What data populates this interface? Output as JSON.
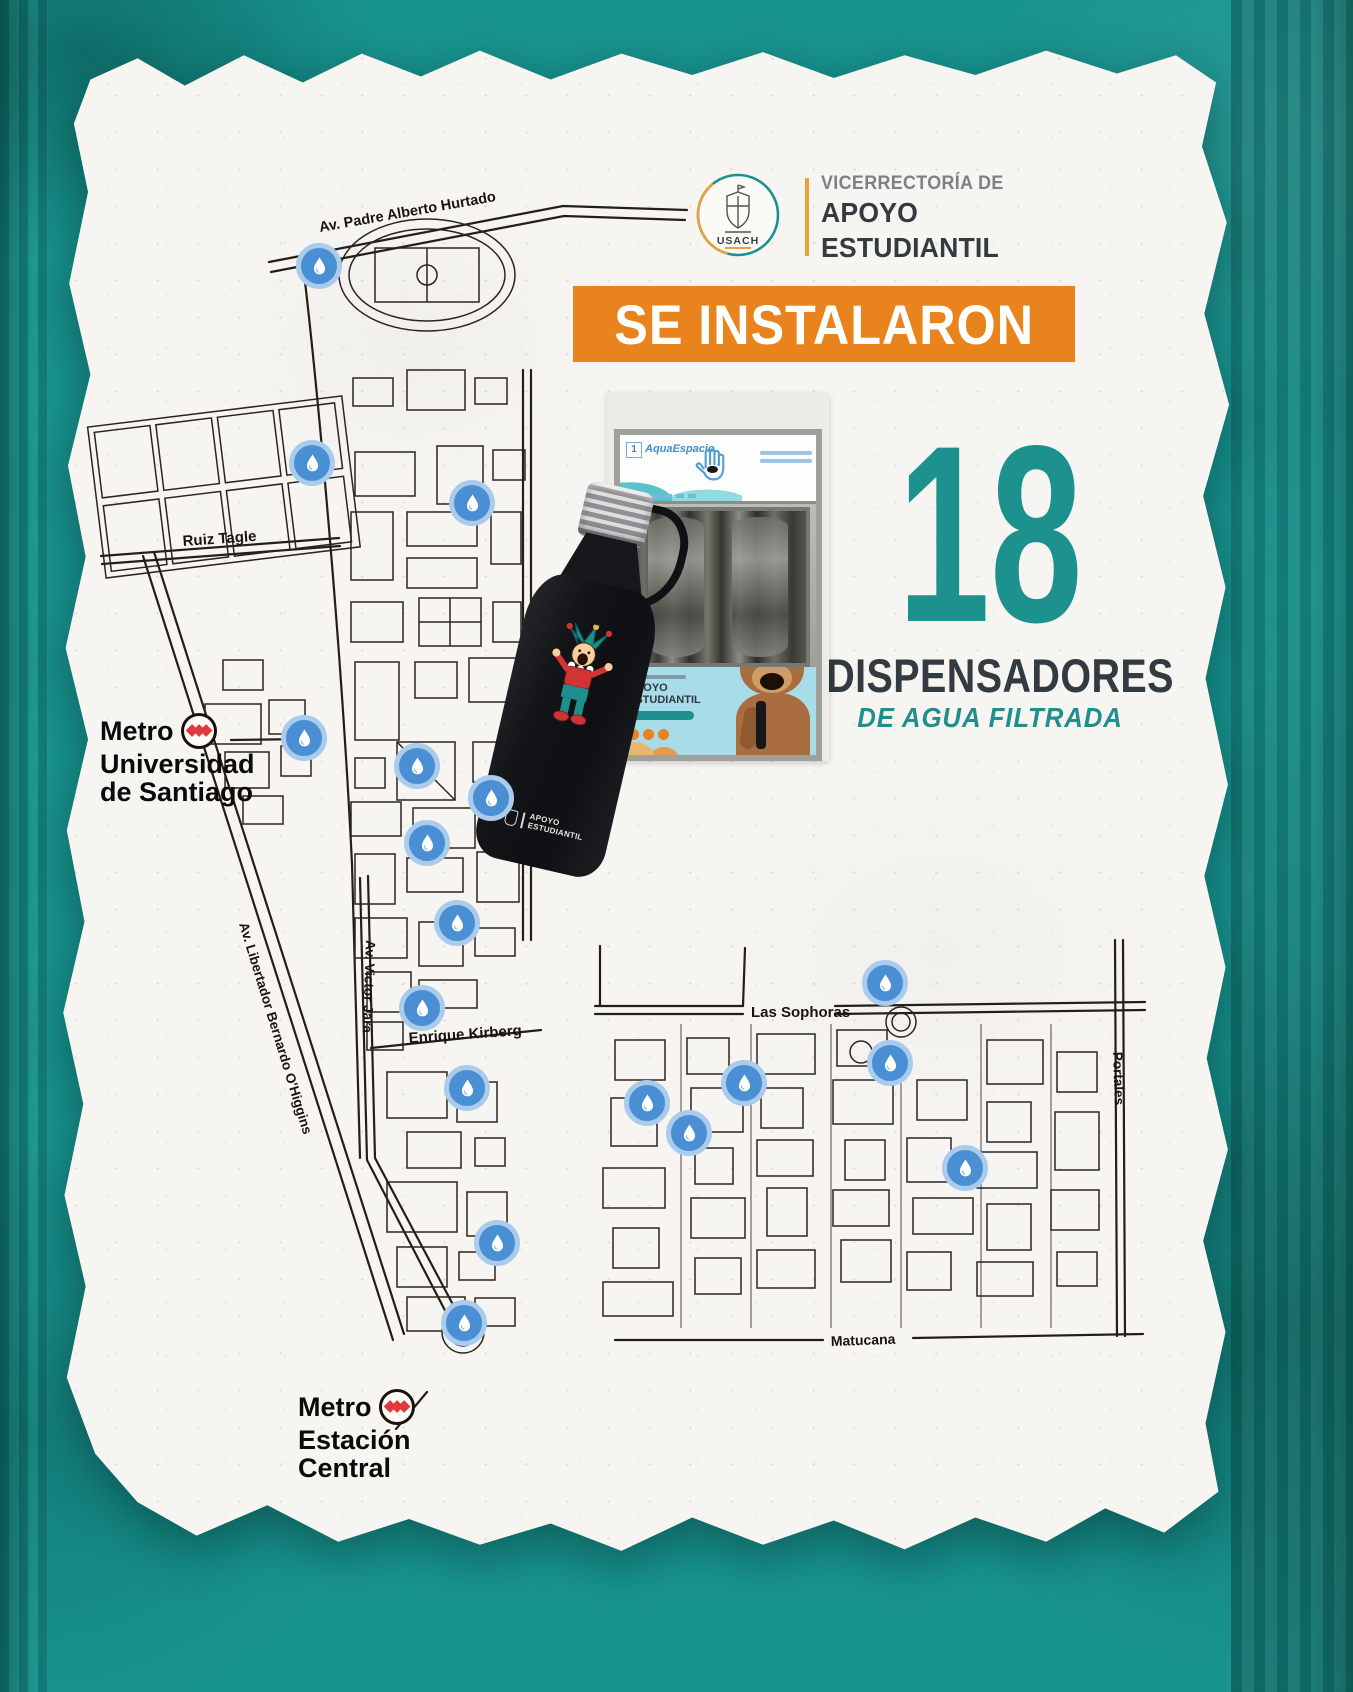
{
  "poster": {
    "header": {
      "logo_text": "USACH",
      "dept_small": "VICERRECTORÍA DE",
      "dept_line1": "APOYO",
      "dept_line2": "ESTUDIANTIL"
    },
    "banner": {
      "text": "SE INSTALARON"
    },
    "stat": {
      "number": "18",
      "label": "DISPENSADORES",
      "sublabel": "DE AGUA FILTRADA"
    },
    "dispenser_photo": {
      "corner_tag": "1",
      "brand": "AquaEspacio",
      "panel_line1": "APOYO",
      "panel_line2": "ESTUDIANTIL"
    },
    "bottle": {
      "brand_line1": "APOYO",
      "brand_line2": "ESTUDIANTIL"
    },
    "map": {
      "streets": [
        {
          "name": "Av. Padre Alberto Hurtado"
        },
        {
          "name": "Ruiz Tagle"
        },
        {
          "name": "El Belloto"
        },
        {
          "name": "Av. Victor Jara"
        },
        {
          "name": "Av. Libertador Bernardo O'Higgins"
        },
        {
          "name": "Enrique Kirberg"
        },
        {
          "name": "Las Sophoras"
        },
        {
          "name": "Portales"
        },
        {
          "name": "Matucana"
        }
      ],
      "metro_stations": [
        {
          "line1": "Metro",
          "line2": "Universidad",
          "line3": "de Santiago"
        },
        {
          "line1": "Metro",
          "line2": "Estación",
          "line3": "Central"
        }
      ],
      "markers": [
        {
          "x": 264,
          "y": 226
        },
        {
          "x": 257,
          "y": 423
        },
        {
          "x": 417,
          "y": 463
        },
        {
          "x": 249,
          "y": 698
        },
        {
          "x": 362,
          "y": 726
        },
        {
          "x": 436,
          "y": 758
        },
        {
          "x": 372,
          "y": 803
        },
        {
          "x": 402,
          "y": 883
        },
        {
          "x": 367,
          "y": 968
        },
        {
          "x": 412,
          "y": 1048
        },
        {
          "x": 592,
          "y": 1063
        },
        {
          "x": 634,
          "y": 1093
        },
        {
          "x": 689,
          "y": 1043
        },
        {
          "x": 830,
          "y": 943
        },
        {
          "x": 835,
          "y": 1023
        },
        {
          "x": 910,
          "y": 1128
        },
        {
          "x": 442,
          "y": 1203
        },
        {
          "x": 409,
          "y": 1283
        }
      ]
    },
    "colors": {
      "background_teal": "#18948f",
      "accent_teal": "#1c918e",
      "accent_orange": "#e8831d",
      "marker_blue": "#4a8fd3",
      "metro_red": "#df393d",
      "text_dark": "#333b41"
    }
  }
}
